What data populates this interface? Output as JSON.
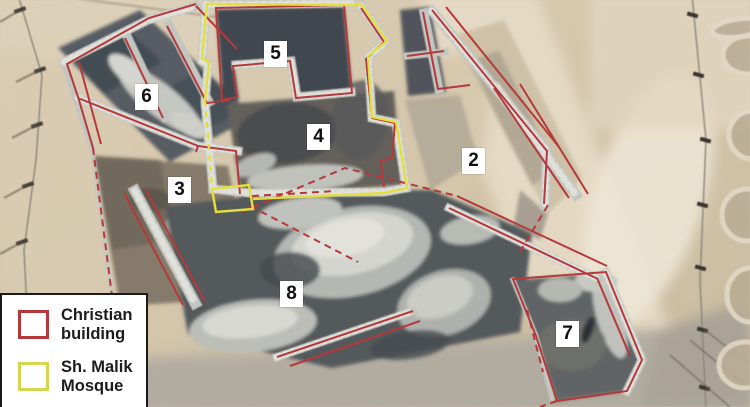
{
  "figure": {
    "type": "annotated aerial photograph of excavated archaeological site",
    "areas": [
      {
        "label": "2"
      },
      {
        "label": "3"
      },
      {
        "label": "4"
      },
      {
        "label": "5"
      },
      {
        "label": "6"
      },
      {
        "label": "7"
      },
      {
        "label": "8"
      }
    ],
    "legend": {
      "items": [
        {
          "label": "Christian building",
          "swatch_color": "#b5393b"
        },
        {
          "label": "Sh. Malik Mosque",
          "swatch_color": "#d3d64e"
        }
      ]
    }
  },
  "colors": {
    "christian_outline": "#b5393b",
    "mosque_outline": "#e4df3e",
    "legend_background": "#ffffff",
    "legend_border": "#1a1a1a",
    "label_background": "#ffffff",
    "label_text": "#111111"
  }
}
